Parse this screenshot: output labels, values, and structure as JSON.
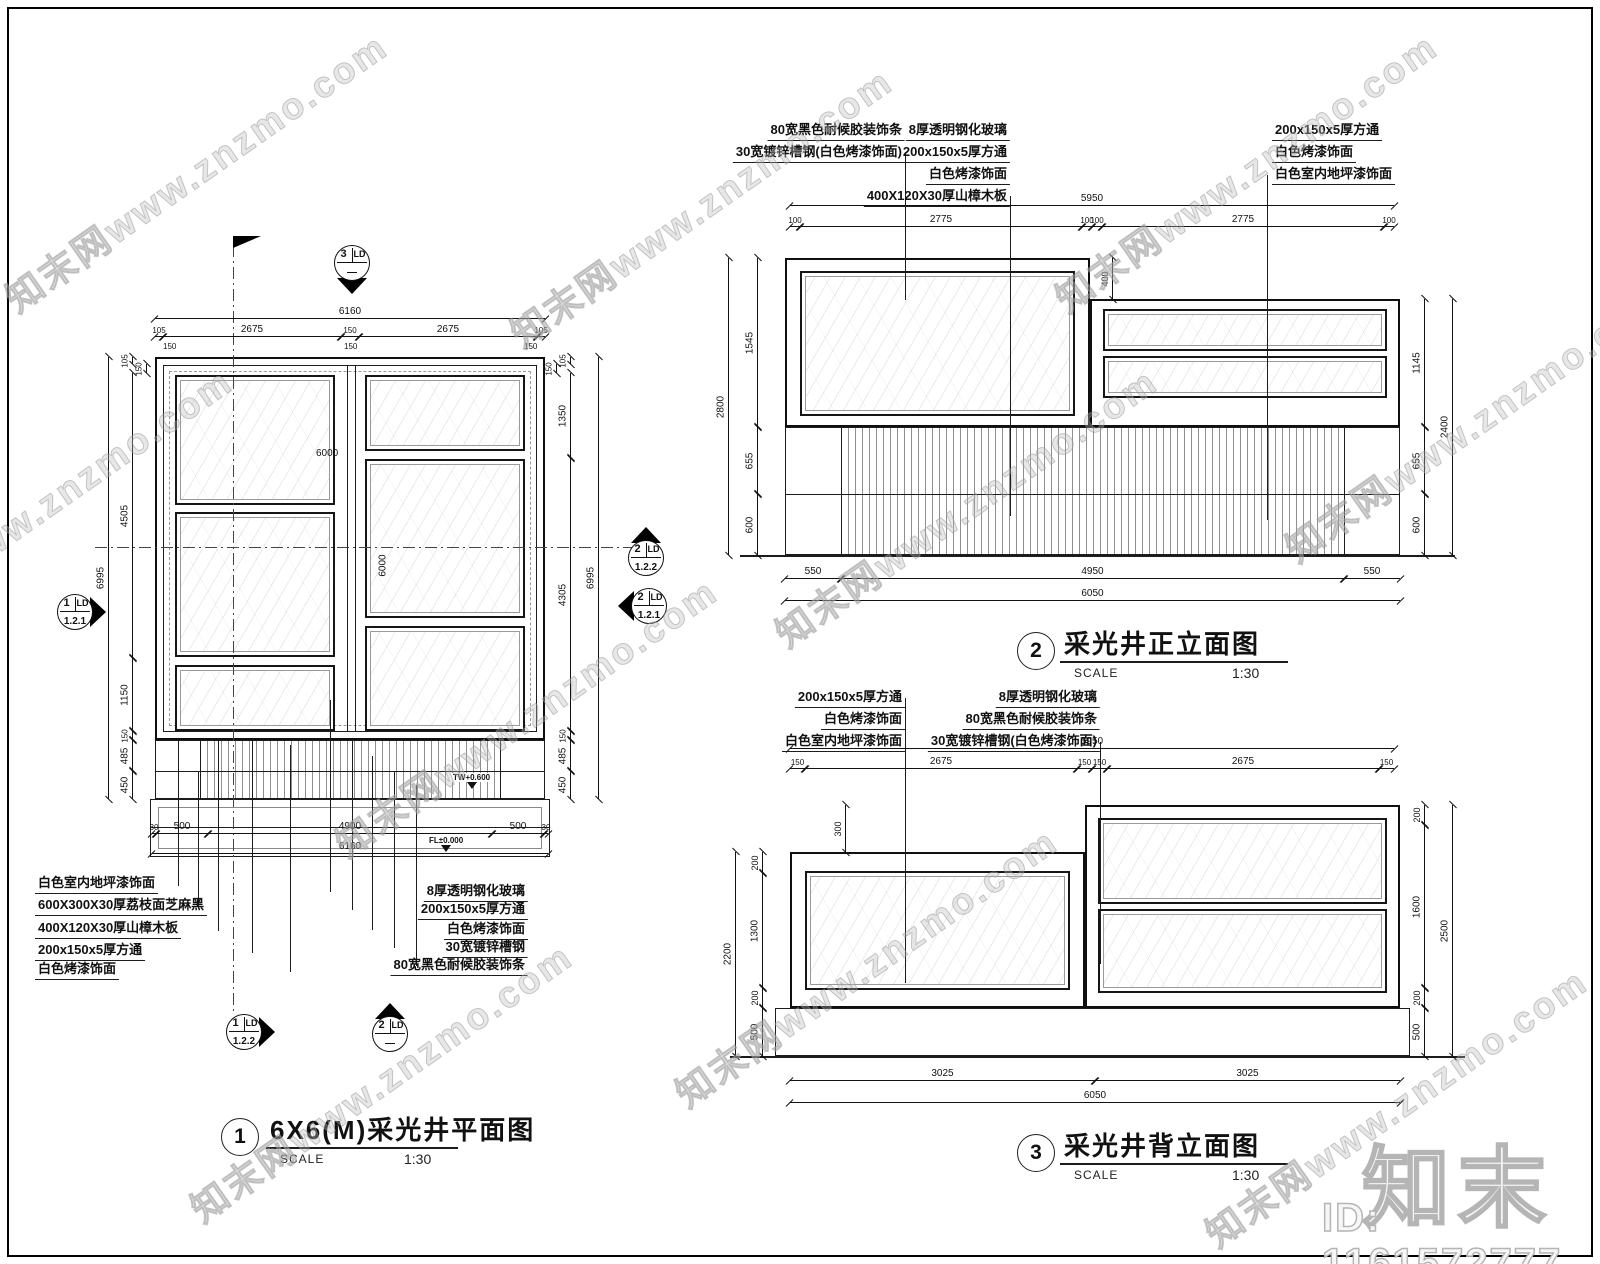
{
  "meta": {
    "watermark_text": "知末网www.znzmo.com",
    "logo_text": "知末",
    "id_text": "ID: 1161572777",
    "line_color": "#1c1c1c",
    "paper_color": "#ffffff"
  },
  "titles": [
    {
      "cx": 240,
      "cy": 1137,
      "n": "1",
      "t": "6X6(M)采光井平面图",
      "sl": "SCALE",
      "sv": "1:30",
      "tx": 270,
      "ty": 1110,
      "ux": 266,
      "uy": 1147,
      "uw": 192,
      "sx": 280,
      "vx": 404,
      "sy": 1152
    },
    {
      "cx": 1036,
      "cy": 651,
      "n": "2",
      "t": "采光井正立面图",
      "sl": "SCALE",
      "sv": "1:30",
      "tx": 1064,
      "ty": 624,
      "ux": 1060,
      "uy": 661,
      "uw": 228,
      "sx": 1074,
      "vx": 1232,
      "sy": 666
    },
    {
      "cx": 1036,
      "cy": 1153,
      "n": "3",
      "t": "采光井背立面图",
      "sl": "SCALE",
      "sv": "1:30",
      "tx": 1064,
      "ty": 1126,
      "ux": 1060,
      "uy": 1163,
      "uw": 228,
      "sx": 1074,
      "vx": 1232,
      "sy": 1168
    }
  ],
  "markers": [
    {
      "cx": 352,
      "cy": 263,
      "n": "3",
      "s": "LD",
      "b": "—",
      "dir": "down"
    },
    {
      "cx": 75,
      "cy": 612,
      "n": "1",
      "s": "LD",
      "b": "1.2.1",
      "dir": "right"
    },
    {
      "cx": 646,
      "cy": 558,
      "n": "2",
      "s": "LD",
      "b": "1.2.2",
      "dir": "up"
    },
    {
      "cx": 649,
      "cy": 606,
      "n": "2",
      "s": "LD",
      "b": "1.2.1",
      "dir": "left"
    },
    {
      "cx": 244,
      "cy": 1032,
      "n": "1",
      "s": "LD",
      "b": "1.2.2",
      "dir": "right"
    },
    {
      "cx": 390,
      "cy": 1034,
      "n": "2",
      "s": "LD",
      "b": "—",
      "dir": "up"
    }
  ],
  "levels": [
    {
      "x": 452,
      "y": 773,
      "t": "TW+0.600"
    },
    {
      "x": 428,
      "y": 836,
      "t": "FL±0.000"
    }
  ],
  "flag": {
    "x": 233,
    "y": 236
  },
  "labels": [
    {
      "x": 35,
      "y": 872,
      "a": "l",
      "t": "白色室内地坪漆饰面"
    },
    {
      "x": 35,
      "y": 894,
      "a": "l",
      "t": "600X300X30厚荔枝面芝麻黑"
    },
    {
      "x": 35,
      "y": 917,
      "a": "l",
      "t": "400X120X30厚山樟木板"
    },
    {
      "x": 35,
      "y": 939,
      "a": "l",
      "t": "200x150x5厚方通"
    },
    {
      "x": 35,
      "y": 958,
      "a": "l",
      "t": "白色烤漆饰面"
    },
    {
      "x": 528,
      "y": 880,
      "a": "r",
      "t": "8厚透明钢化玻璃"
    },
    {
      "x": 528,
      "y": 898,
      "a": "r",
      "t": "200x150x5厚方通"
    },
    {
      "x": 528,
      "y": 918,
      "a": "r",
      "t": "白色烤漆饰面"
    },
    {
      "x": 528,
      "y": 936,
      "a": "r",
      "t": "30宽镀锌槽钢"
    },
    {
      "x": 528,
      "y": 954,
      "a": "r",
      "t": "80宽黑色耐候胶装饰条"
    },
    {
      "x": 905,
      "y": 119,
      "a": "r",
      "t": "80宽黑色耐候胶装饰条"
    },
    {
      "x": 905,
      "y": 141,
      "a": "r",
      "t": "30宽镀锌槽钢(白色烤漆饰面)"
    },
    {
      "x": 1010,
      "y": 119,
      "a": "r",
      "t": "8厚透明钢化玻璃"
    },
    {
      "x": 1010,
      "y": 141,
      "a": "r",
      "t": "200x150x5厚方通"
    },
    {
      "x": 1010,
      "y": 163,
      "a": "r",
      "t": "白色烤漆饰面"
    },
    {
      "x": 1010,
      "y": 185,
      "a": "r",
      "t": "400X120X30厚山樟木板"
    },
    {
      "x": 1272,
      "y": 119,
      "a": "l",
      "t": "200x150x5厚方通"
    },
    {
      "x": 1272,
      "y": 141,
      "a": "l",
      "t": "白色烤漆饰面"
    },
    {
      "x": 1272,
      "y": 163,
      "a": "l",
      "t": "白色室内地坪漆饰面"
    },
    {
      "x": 905,
      "y": 686,
      "a": "r",
      "t": "200x150x5厚方通"
    },
    {
      "x": 905,
      "y": 708,
      "a": "r",
      "t": "白色烤漆饰面"
    },
    {
      "x": 905,
      "y": 730,
      "a": "r",
      "t": "白色室内地坪漆饰面"
    },
    {
      "x": 1100,
      "y": 686,
      "a": "r",
      "t": "8厚透明钢化玻璃"
    },
    {
      "x": 1100,
      "y": 708,
      "a": "r",
      "t": "80宽黑色耐候胶装饰条"
    },
    {
      "x": 1100,
      "y": 730,
      "a": "r",
      "t": "30宽镀锌槽钢(白色烤漆饰面)"
    }
  ],
  "texts": [
    {
      "x": 316,
      "y": 448,
      "t": "6000",
      "f": 10
    },
    {
      "x": 372,
      "y": 560,
      "t": "6000",
      "f": 10,
      "r": -90
    },
    {
      "x": 163,
      "y": 342,
      "t": "150",
      "f": 8
    },
    {
      "x": 344,
      "y": 342,
      "t": "150",
      "f": 8
    },
    {
      "x": 524,
      "y": 342,
      "t": "150",
      "f": 8
    }
  ],
  "dims": {
    "h": [
      {
        "x": 155,
        "y": 318,
        "w": 390,
        "t": "6160"
      },
      {
        "x": 155,
        "y": 336,
        "w": 8,
        "t": "105",
        "f": 8
      },
      {
        "x": 163,
        "y": 336,
        "w": 178,
        "t": "2675"
      },
      {
        "x": 341,
        "y": 336,
        "w": 18,
        "t": "150",
        "f": 8
      },
      {
        "x": 359,
        "y": 336,
        "w": 178,
        "t": "2675"
      },
      {
        "x": 537,
        "y": 336,
        "w": 8,
        "t": "105",
        "f": 8
      },
      {
        "x": 152,
        "y": 833,
        "w": 4,
        "t": "30",
        "f": 8
      },
      {
        "x": 156,
        "y": 833,
        "w": 52,
        "t": "500"
      },
      {
        "x": 208,
        "y": 833,
        "w": 284,
        "t": "4900"
      },
      {
        "x": 492,
        "y": 833,
        "w": 52,
        "t": "500"
      },
      {
        "x": 544,
        "y": 833,
        "w": 4,
        "t": "30",
        "f": 8
      },
      {
        "x": 152,
        "y": 853,
        "w": 396,
        "t": "6160"
      },
      {
        "x": 790,
        "y": 205,
        "w": 604,
        "t": "5950"
      },
      {
        "x": 790,
        "y": 226,
        "w": 10,
        "t": "100",
        "f": 8
      },
      {
        "x": 800,
        "y": 226,
        "w": 282,
        "t": "2775"
      },
      {
        "x": 1082,
        "y": 226,
        "w": 10,
        "t": "100",
        "f": 8
      },
      {
        "x": 1092,
        "y": 226,
        "w": 10,
        "t": "100",
        "f": 8
      },
      {
        "x": 1102,
        "y": 226,
        "w": 282,
        "t": "2775"
      },
      {
        "x": 1384,
        "y": 226,
        "w": 10,
        "t": "100",
        "f": 8
      },
      {
        "x": 785,
        "y": 578,
        "w": 56,
        "t": "550"
      },
      {
        "x": 841,
        "y": 578,
        "w": 503,
        "t": "4950"
      },
      {
        "x": 1344,
        "y": 578,
        "w": 56,
        "t": "550"
      },
      {
        "x": 785,
        "y": 600,
        "w": 615,
        "t": "6050"
      },
      {
        "x": 790,
        "y": 748,
        "w": 604,
        "t": "5950"
      },
      {
        "x": 790,
        "y": 768,
        "w": 15,
        "t": "150",
        "f": 8
      },
      {
        "x": 805,
        "y": 768,
        "w": 272,
        "t": "2675"
      },
      {
        "x": 1077,
        "y": 768,
        "w": 15,
        "t": "150",
        "f": 8
      },
      {
        "x": 1092,
        "y": 768,
        "w": 15,
        "t": "150",
        "f": 8
      },
      {
        "x": 1107,
        "y": 768,
        "w": 272,
        "t": "2675"
      },
      {
        "x": 1379,
        "y": 768,
        "w": 15,
        "t": "150",
        "f": 8
      },
      {
        "x": 790,
        "y": 1080,
        "w": 305,
        "t": "3025"
      },
      {
        "x": 1095,
        "y": 1080,
        "w": 305,
        "t": "3025"
      },
      {
        "x": 790,
        "y": 1102,
        "w": 610,
        "t": "6050"
      }
    ],
    "v": [
      {
        "x": 132,
        "y": 357,
        "h": 7,
        "t": "105",
        "f": 8
      },
      {
        "x": 146,
        "y": 364,
        "h": 9,
        "t": "150",
        "f": 8
      },
      {
        "x": 132,
        "y": 373,
        "h": 285,
        "t": "4505"
      },
      {
        "x": 132,
        "y": 658,
        "h": 73,
        "t": "1150"
      },
      {
        "x": 132,
        "y": 731,
        "h": 9,
        "t": "150",
        "f": 8
      },
      {
        "x": 132,
        "y": 740,
        "h": 31,
        "t": "485"
      },
      {
        "x": 132,
        "y": 771,
        "h": 28,
        "t": "450"
      },
      {
        "x": 108,
        "y": 357,
        "h": 442,
        "t": "6995"
      },
      {
        "x": 570,
        "y": 357,
        "h": 7,
        "t": "105",
        "f": 8
      },
      {
        "x": 556,
        "y": 364,
        "h": 9,
        "t": "150",
        "f": 8
      },
      {
        "x": 570,
        "y": 373,
        "h": 85,
        "t": "1350"
      },
      {
        "x": 570,
        "y": 458,
        "h": 273,
        "t": "4305"
      },
      {
        "x": 570,
        "y": 731,
        "h": 9,
        "t": "150",
        "f": 8
      },
      {
        "x": 570,
        "y": 740,
        "h": 31,
        "t": "485"
      },
      {
        "x": 570,
        "y": 771,
        "h": 28,
        "t": "450"
      },
      {
        "x": 598,
        "y": 357,
        "h": 442,
        "t": "6995"
      },
      {
        "x": 757,
        "y": 258,
        "h": 169,
        "t": "1545"
      },
      {
        "x": 757,
        "y": 427,
        "h": 67,
        "t": "655"
      },
      {
        "x": 757,
        "y": 494,
        "h": 61,
        "t": "600"
      },
      {
        "x": 728,
        "y": 258,
        "h": 297,
        "t": "2800"
      },
      {
        "x": 1112,
        "y": 258,
        "h": 41,
        "t": "400",
        "f": 9
      },
      {
        "x": 1424,
        "y": 299,
        "h": 128,
        "t": "1145"
      },
      {
        "x": 1424,
        "y": 427,
        "h": 67,
        "t": "655"
      },
      {
        "x": 1424,
        "y": 494,
        "h": 61,
        "t": "600"
      },
      {
        "x": 1452,
        "y": 299,
        "h": 256,
        "t": "2400"
      },
      {
        "x": 845,
        "y": 805,
        "h": 47,
        "t": "300",
        "f": 9
      },
      {
        "x": 762,
        "y": 852,
        "h": 21,
        "t": "200",
        "f": 9
      },
      {
        "x": 762,
        "y": 873,
        "h": 115,
        "t": "1300"
      },
      {
        "x": 762,
        "y": 988,
        "h": 20,
        "t": "200",
        "f": 9
      },
      {
        "x": 762,
        "y": 1008,
        "h": 48,
        "t": "500"
      },
      {
        "x": 735,
        "y": 852,
        "h": 204,
        "t": "2200"
      },
      {
        "x": 1424,
        "y": 805,
        "h": 20,
        "t": "200",
        "f": 9
      },
      {
        "x": 1424,
        "y": 825,
        "h": 163,
        "t": "1600"
      },
      {
        "x": 1424,
        "y": 988,
        "h": 20,
        "t": "200",
        "f": 9
      },
      {
        "x": 1424,
        "y": 1008,
        "h": 48,
        "t": "500"
      },
      {
        "x": 1452,
        "y": 805,
        "h": 251,
        "t": "2500"
      }
    ]
  },
  "shapes": {
    "rects": [
      {
        "x": 155,
        "y": 357,
        "w": 390,
        "h": 383,
        "c": "b2"
      },
      {
        "x": 163,
        "y": 365,
        "w": 374,
        "h": 367,
        "c": "b1"
      },
      {
        "x": 169,
        "y": 371,
        "w": 362,
        "h": 355,
        "c": "dashed"
      },
      {
        "x": 175,
        "y": 375,
        "w": 160,
        "h": 130,
        "c": "glass"
      },
      {
        "x": 175,
        "y": 512,
        "w": 160,
        "h": 145,
        "c": "glass"
      },
      {
        "x": 175,
        "y": 665,
        "w": 160,
        "h": 66,
        "c": "glass"
      },
      {
        "x": 365,
        "y": 375,
        "w": 160,
        "h": 76,
        "c": "glass"
      },
      {
        "x": 365,
        "y": 459,
        "w": 160,
        "h": 159,
        "c": "glass"
      },
      {
        "x": 365,
        "y": 626,
        "w": 160,
        "h": 105,
        "c": "glass"
      },
      {
        "x": 200,
        "y": 740,
        "w": 300,
        "h": 59,
        "c": "stripes"
      },
      {
        "x": 155,
        "y": 740,
        "w": 390,
        "h": 59,
        "c": "b1"
      },
      {
        "x": 150,
        "y": 799,
        "w": 400,
        "h": 58,
        "c": "b1"
      },
      {
        "x": 158,
        "y": 807,
        "w": 384,
        "h": 42,
        "c": "lite"
      },
      {
        "x": 785,
        "y": 258,
        "w": 305,
        "h": 169,
        "c": "b2"
      },
      {
        "x": 800,
        "y": 271,
        "w": 275,
        "h": 145,
        "c": "glass"
      },
      {
        "x": 1090,
        "y": 299,
        "w": 310,
        "h": 128,
        "c": "b2"
      },
      {
        "x": 1103,
        "y": 309,
        "w": 284,
        "h": 42,
        "c": "glass"
      },
      {
        "x": 1103,
        "y": 356,
        "w": 284,
        "h": 42,
        "c": "glass"
      },
      {
        "x": 841,
        "y": 427,
        "w": 503,
        "h": 128,
        "c": "stripes"
      },
      {
        "x": 785,
        "y": 427,
        "w": 615,
        "h": 128,
        "c": "b1"
      },
      {
        "x": 1085,
        "y": 805,
        "w": 315,
        "h": 203,
        "c": "b2"
      },
      {
        "x": 1098,
        "y": 818,
        "w": 289,
        "h": 86,
        "c": "glass"
      },
      {
        "x": 1098,
        "y": 909,
        "w": 289,
        "h": 84,
        "c": "glass"
      },
      {
        "x": 790,
        "y": 852,
        "w": 295,
        "h": 156,
        "c": "b2"
      },
      {
        "x": 805,
        "y": 871,
        "w": 265,
        "h": 119,
        "c": "glass"
      },
      {
        "x": 775,
        "y": 1008,
        "w": 635,
        "h": 48,
        "c": "b1"
      }
    ],
    "lines": [
      {
        "x": 347,
        "y": 365,
        "l": 367,
        "o": "v"
      },
      {
        "x": 355,
        "y": 365,
        "l": 367,
        "o": "v"
      },
      {
        "x": 200,
        "y": 740,
        "l": 59,
        "o": "v"
      },
      {
        "x": 500,
        "y": 740,
        "l": 59,
        "o": "v"
      },
      {
        "x": 155,
        "y": 771,
        "l": 390,
        "o": "h"
      },
      {
        "x": 150,
        "y": 827,
        "l": 400,
        "o": "h"
      },
      {
        "x": 233,
        "y": 245,
        "l": 767,
        "o": "v",
        "c": "cl"
      },
      {
        "x": 95,
        "y": 547,
        "l": 550,
        "o": "h",
        "c": "clh"
      },
      {
        "x": 178,
        "y": 740,
        "l": 146,
        "o": "v"
      },
      {
        "x": 198,
        "y": 771,
        "l": 137,
        "o": "v"
      },
      {
        "x": 218,
        "y": 740,
        "l": 191,
        "o": "v"
      },
      {
        "x": 252,
        "y": 740,
        "l": 213,
        "o": "v"
      },
      {
        "x": 290,
        "y": 745,
        "l": 227,
        "o": "v"
      },
      {
        "x": 330,
        "y": 700,
        "l": 192,
        "o": "v"
      },
      {
        "x": 352,
        "y": 740,
        "l": 170,
        "o": "v"
      },
      {
        "x": 372,
        "y": 756,
        "l": 174,
        "o": "v"
      },
      {
        "x": 394,
        "y": 771,
        "l": 177,
        "o": "v"
      },
      {
        "x": 416,
        "y": 785,
        "l": 181,
        "o": "v"
      },
      {
        "x": 905,
        "y": 152,
        "l": 148,
        "o": "v"
      },
      {
        "x": 1010,
        "y": 196,
        "l": 320,
        "o": "v"
      },
      {
        "x": 1267,
        "y": 175,
        "l": 345,
        "o": "v"
      },
      {
        "x": 785,
        "y": 494,
        "l": 615,
        "o": "h"
      },
      {
        "x": 841,
        "y": 427,
        "l": 128,
        "o": "v"
      },
      {
        "x": 1344,
        "y": 427,
        "l": 128,
        "o": "v"
      },
      {
        "x": 740,
        "y": 555,
        "l": 715,
        "o": "h",
        "w": 2
      },
      {
        "x": 905,
        "y": 698,
        "l": 285,
        "o": "v"
      },
      {
        "x": 1100,
        "y": 742,
        "l": 222,
        "o": "v"
      },
      {
        "x": 730,
        "y": 1056,
        "l": 735,
        "o": "h",
        "w": 2
      }
    ]
  },
  "watermarks": [
    {
      "x": 195,
      "y": 170
    },
    {
      "x": 700,
      "y": 205
    },
    {
      "x": 1245,
      "y": 170
    },
    {
      "x": 40,
      "y": 505
    },
    {
      "x": 525,
      "y": 715
    },
    {
      "x": 965,
      "y": 505
    },
    {
      "x": 1475,
      "y": 420
    },
    {
      "x": 380,
      "y": 1080
    },
    {
      "x": 865,
      "y": 965
    },
    {
      "x": 1395,
      "y": 1105
    }
  ]
}
